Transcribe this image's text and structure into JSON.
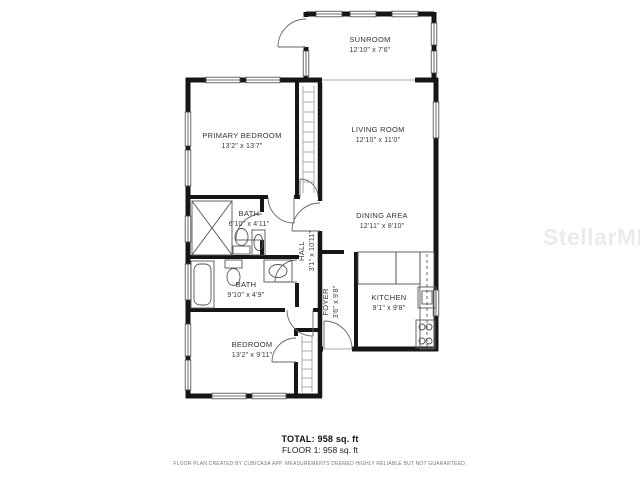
{
  "watermark": {
    "text": "StellarMLS",
    "color": "#ebebee"
  },
  "rooms": {
    "sunroom": {
      "name": "SUNROOM",
      "dims": "12'10\" x 7'6\""
    },
    "primary_bedroom": {
      "name": "PRIMARY BEDROOM",
      "dims": "13'2\" x 13'7\""
    },
    "living_room": {
      "name": "LIVING ROOM",
      "dims": "12'10\" x 11'0\""
    },
    "bath_upper": {
      "name": "BATH",
      "dims": "6'10\" x 4'11\""
    },
    "hall": {
      "name": "HALL",
      "dims": "3'1\" x 10'11\""
    },
    "dining_area": {
      "name": "DINING AREA",
      "dims": "12'11\" x 8'10\""
    },
    "bath_lower": {
      "name": "BATH",
      "dims": "9'10\" x 4'9\""
    },
    "foyer": {
      "name": "FOYER",
      "dims": "3'6\" x 9'8\""
    },
    "kitchen": {
      "name": "KITCHEN",
      "dims": "9'1\" x 9'8\""
    },
    "bedroom": {
      "name": "BEDROOM",
      "dims": "13'2\" x 9'11\""
    }
  },
  "summary": {
    "total_label": "TOTAL: 958 sq. ft",
    "floor_label": "FLOOR 1: 958 sq. ft"
  },
  "disclaimer": "FLOOR PLAN CREATED BY CUBICASA APP. MEASUREMENTS DEEMED HIGHLY RELIABLE BUT NOT GUARANTEED.",
  "colors": {
    "walls": "#161616",
    "room_text": "#333333",
    "disclaimer_text": "#777777"
  }
}
